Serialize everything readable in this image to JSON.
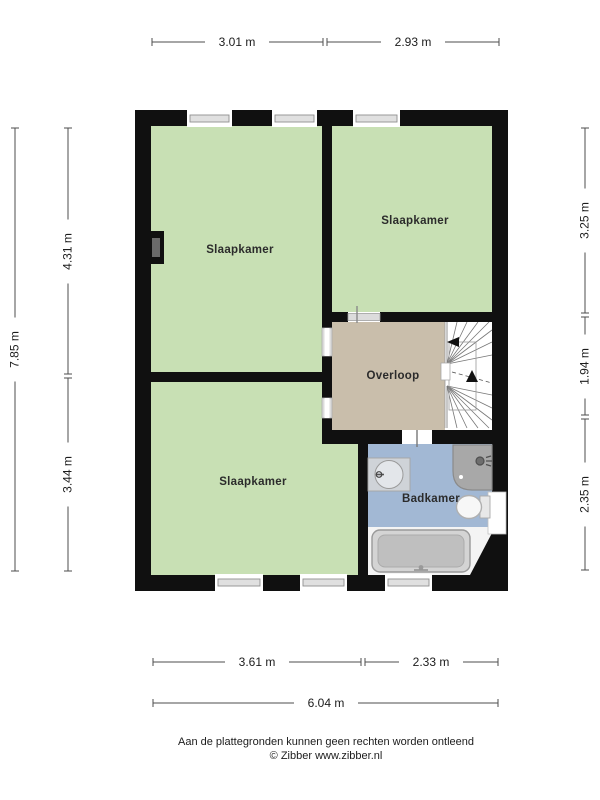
{
  "plan": {
    "type": "floorplan",
    "rooms": {
      "bedroom_top_left": {
        "label": "Slaapkamer"
      },
      "bedroom_top_right": {
        "label": "Slaapkamer"
      },
      "bedroom_bottom_left": {
        "label": "Slaapkamer"
      },
      "landing": {
        "label": "Overloop"
      },
      "bathroom": {
        "label": "Badkamer"
      }
    },
    "fixtures": [
      "staircase",
      "corner-shower",
      "sink",
      "toilet",
      "bathtub",
      "chimney",
      "windows"
    ]
  },
  "dimensions": {
    "top": [
      {
        "label": "3.01 m"
      },
      {
        "label": "2.93 m"
      }
    ],
    "left_total": {
      "label": "7.85 m"
    },
    "left": [
      {
        "label": "4.31 m"
      },
      {
        "label": "3.44 m"
      }
    ],
    "right": [
      {
        "label": "3.25 m"
      },
      {
        "label": "1.94 m"
      },
      {
        "label": "2.35 m"
      }
    ],
    "bottom": [
      {
        "label": "3.61 m"
      },
      {
        "label": "2.33 m"
      }
    ],
    "bottom_total": {
      "label": "6.04 m"
    }
  },
  "footer": {
    "disclaimer": "Aan de plattegronden kunnen geen rechten worden ontleend",
    "copyright": "© Zibber www.zibber.nl"
  },
  "colors": {
    "room_green": "#c8e0b4",
    "landing_tan": "#c9beab",
    "bathroom_blue": "#a2b8d4",
    "wall": "#101010",
    "dim_line": "#4d4d4d"
  }
}
